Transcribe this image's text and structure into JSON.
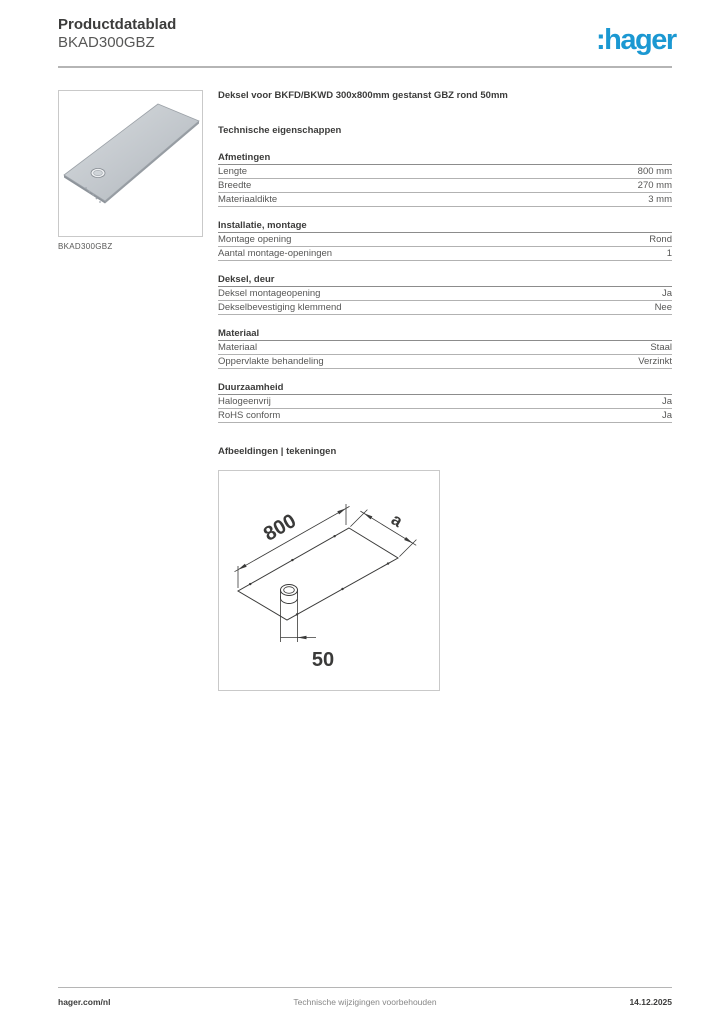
{
  "header": {
    "doc_type": "Productdatablad",
    "product_code": "BKAD300GBZ",
    "logo_text": ":hager",
    "brand_color": "#1b98d2"
  },
  "product_image": {
    "caption": "BKAD300GBZ"
  },
  "content": {
    "title": "Deksel voor BKFD/BKWD 300x800mm gestanst GBZ rond 50mm",
    "tech_heading": "Technische eigenschappen",
    "sections": [
      {
        "heading": "Afmetingen",
        "rows": [
          {
            "label": "Lengte",
            "value": "800 mm"
          },
          {
            "label": "Breedte",
            "value": "270 mm"
          },
          {
            "label": "Materiaaldikte",
            "value": "3 mm"
          }
        ]
      },
      {
        "heading": "Installatie, montage",
        "rows": [
          {
            "label": "Montage opening",
            "value": "Rond"
          },
          {
            "label": "Aantal montage-openingen",
            "value": "1"
          }
        ]
      },
      {
        "heading": "Deksel, deur",
        "rows": [
          {
            "label": "Deksel montageopening",
            "value": "Ja"
          },
          {
            "label": "Dekselbevestiging klemmend",
            "value": "Nee"
          }
        ]
      },
      {
        "heading": "Materiaal",
        "rows": [
          {
            "label": "Materiaal",
            "value": "Staal"
          },
          {
            "label": "Oppervlakte behandeling",
            "value": "Verzinkt"
          }
        ]
      },
      {
        "heading": "Duurzaamheid",
        "rows": [
          {
            "label": "Halogeenvrij",
            "value": "Ja"
          },
          {
            "label": "RoHS conform",
            "value": "Ja"
          }
        ]
      }
    ],
    "drawings_heading": "Afbeeldingen | tekeningen",
    "drawing": {
      "dim_length": "800",
      "dim_width": "a",
      "dim_hole": "50"
    }
  },
  "footer": {
    "website": "hager.com/nl",
    "disclaimer": "Technische wijzigingen voorbehouden",
    "date": "14.12.2025"
  }
}
